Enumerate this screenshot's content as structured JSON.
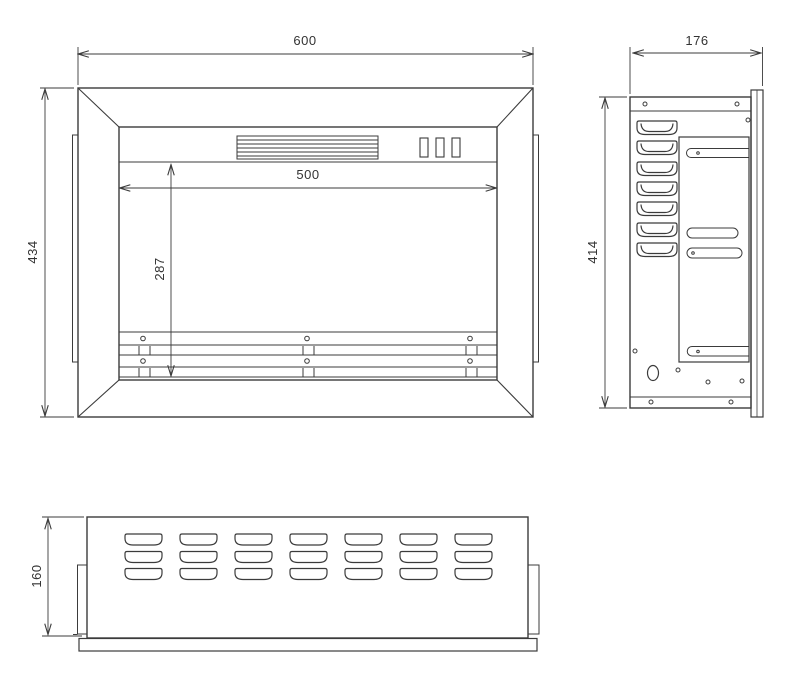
{
  "page": {
    "background": "#ffffff"
  },
  "drawing": {
    "type": "technical-orthographic-drawing",
    "views": [
      "front-view",
      "side-view",
      "bottom-view"
    ],
    "line_color": "#3b3b3b",
    "text_color": "#333333"
  },
  "dims": {
    "front_width": "600",
    "front_height": "434",
    "opening_width": "500",
    "opening_height": "287",
    "side_depth": "176",
    "side_height": "414",
    "base_depth": "160"
  },
  "counts": {
    "side_louvers": 7,
    "bottom_vent_rows": 3,
    "bottom_vent_columns": 7,
    "front_buttons": 3,
    "front_rail_screws": 6
  }
}
